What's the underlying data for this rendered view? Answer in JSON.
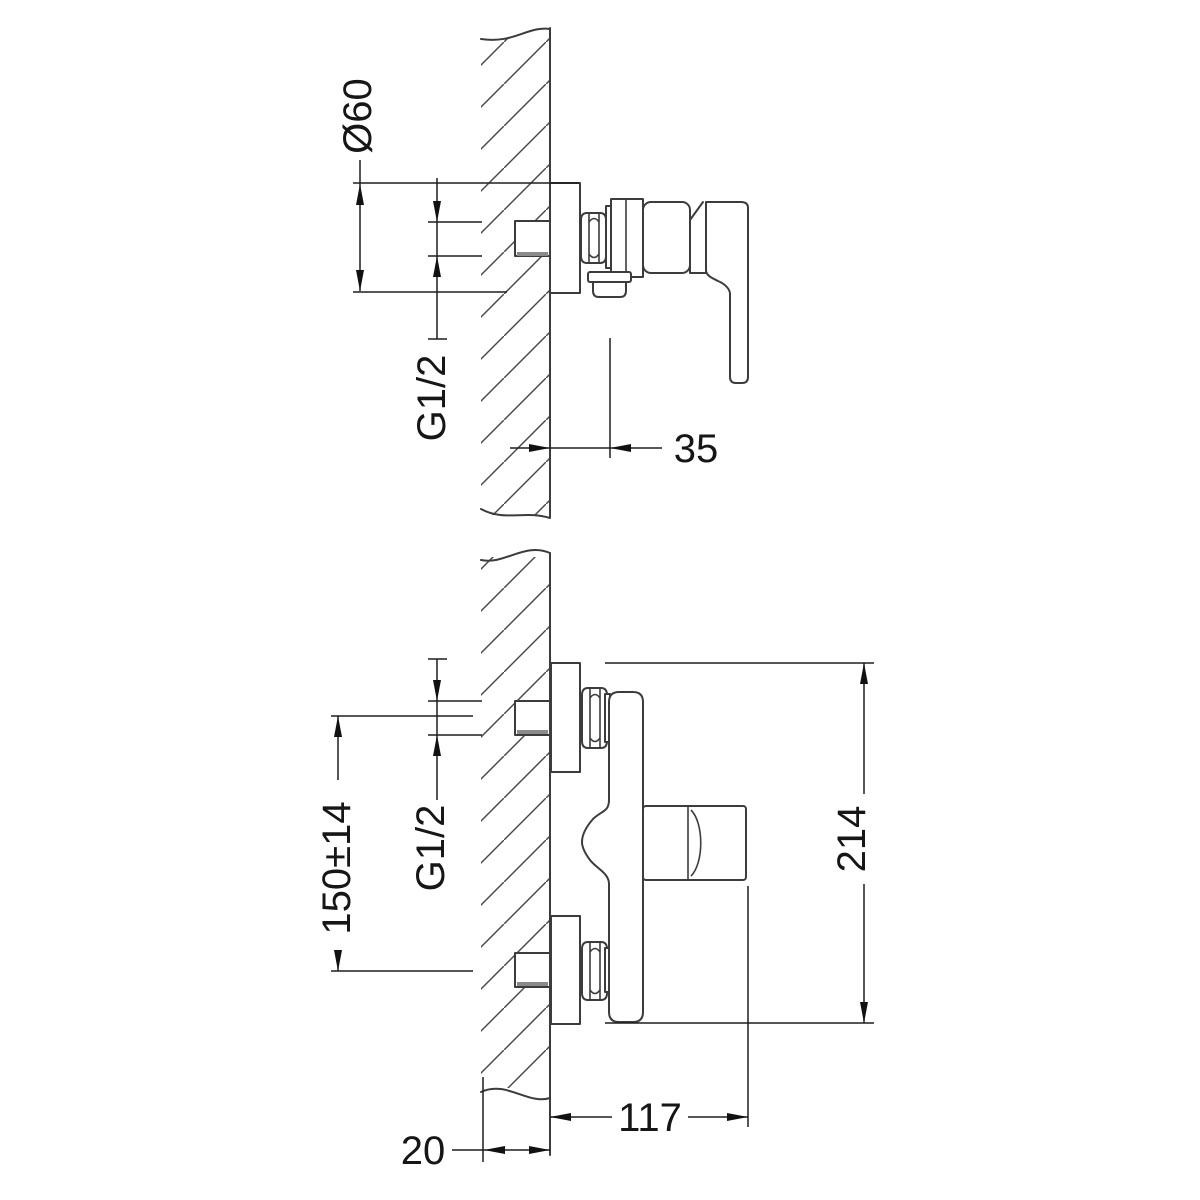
{
  "page": {
    "background": "#ffffff"
  },
  "drawing": {
    "type": "technical-installation-drawing",
    "subject": "wall-mounted single-lever shower mixer, two side views with mounting dimensions",
    "wall_hatch_direction": "diagonal",
    "line_color": "#3c3c3c",
    "dimension_color": "#1e1e1e",
    "labels": {
      "top_flange_diameter": "Ø60",
      "top_thread": "G1/2",
      "top_outlet_offset": "35",
      "bottom_interaxis": "150±14",
      "bottom_thread": "G1/2",
      "bottom_total_height": "214",
      "bottom_projection": "117",
      "bottom_pipe_stickout": "20"
    }
  }
}
